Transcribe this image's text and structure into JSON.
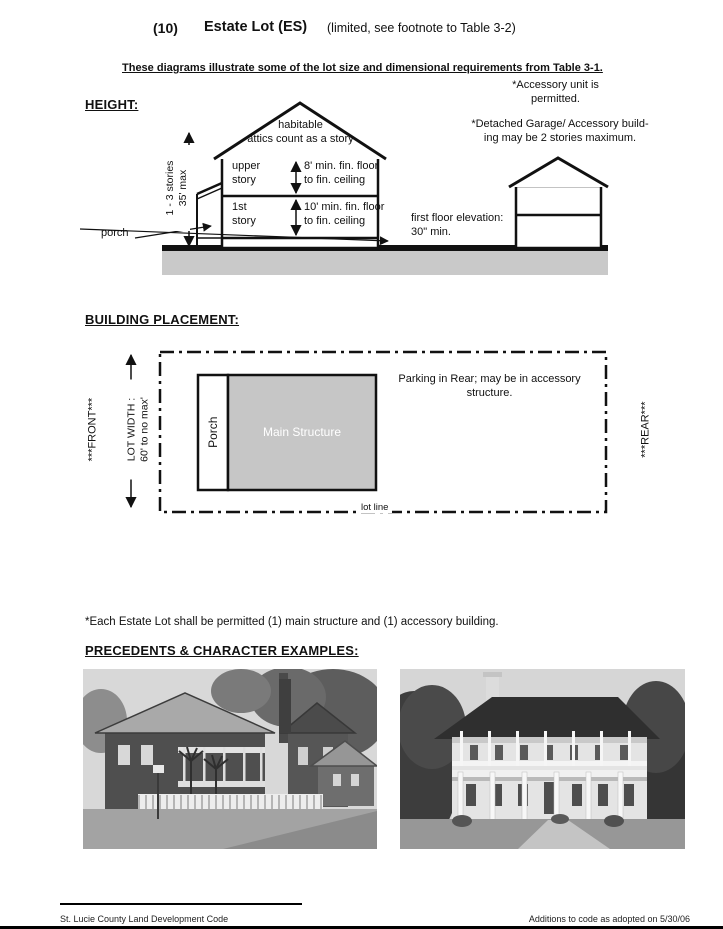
{
  "header": {
    "number": "(10)",
    "title": "Estate Lot  (ES)",
    "note": "(limited, see footnote to Table 3-2)",
    "intro": "These diagrams illustrate some of the lot size and dimensional requirements from Table 3-1."
  },
  "height": {
    "heading": "HEIGHT:",
    "accessory_unit_note": "*Accessory unit is\npermitted.",
    "detached_garage_note": "*Detached Garage/ Accessory build-\ning may be 2 stories maximum.",
    "stories_max": "1 - 3 stories\n35' max",
    "attic": "habitable\nattics count as a story",
    "upper_story": "upper\nstory",
    "upper_story_height": "8' min. fin. floor\nto fin. ceiling",
    "first_story": "1st\nstory",
    "first_story_height": "10' min. fin. floor\nto fin. ceiling",
    "porch": "porch",
    "first_floor_elevation": "first floor elevation:\n30\" min."
  },
  "placement": {
    "heading": "BUILDING PLACEMENT:",
    "front": "***FRONT***",
    "lot_width": "LOT WIDTH :\n60' to no max'",
    "porch": "Porch",
    "main_structure": "Main Structure",
    "parking": "Parking in Rear; may be in accessory\nstructure.",
    "rear": "***REAR***",
    "lot_line": "lot line"
  },
  "footnote": "*Each Estate Lot shall be permitted (1) main structure and (1) accessory building.",
  "precedents": {
    "heading": "PRECEDENTS & CHARACTER EXAMPLES:",
    "photos": [
      {
        "description": "Two-story wood house with double porches, palm trees and white picket fence"
      },
      {
        "description": "White two-story house with wraparound verandas and hip roof"
      }
    ]
  },
  "footer": {
    "left": "St. Lucie County Land Development Code",
    "right": "Additions to code as adopted on 5/30/06"
  },
  "colors": {
    "ground_gray": "#c9c9c9",
    "structure_gray": "#c6c6c6",
    "ink": "#111111"
  }
}
